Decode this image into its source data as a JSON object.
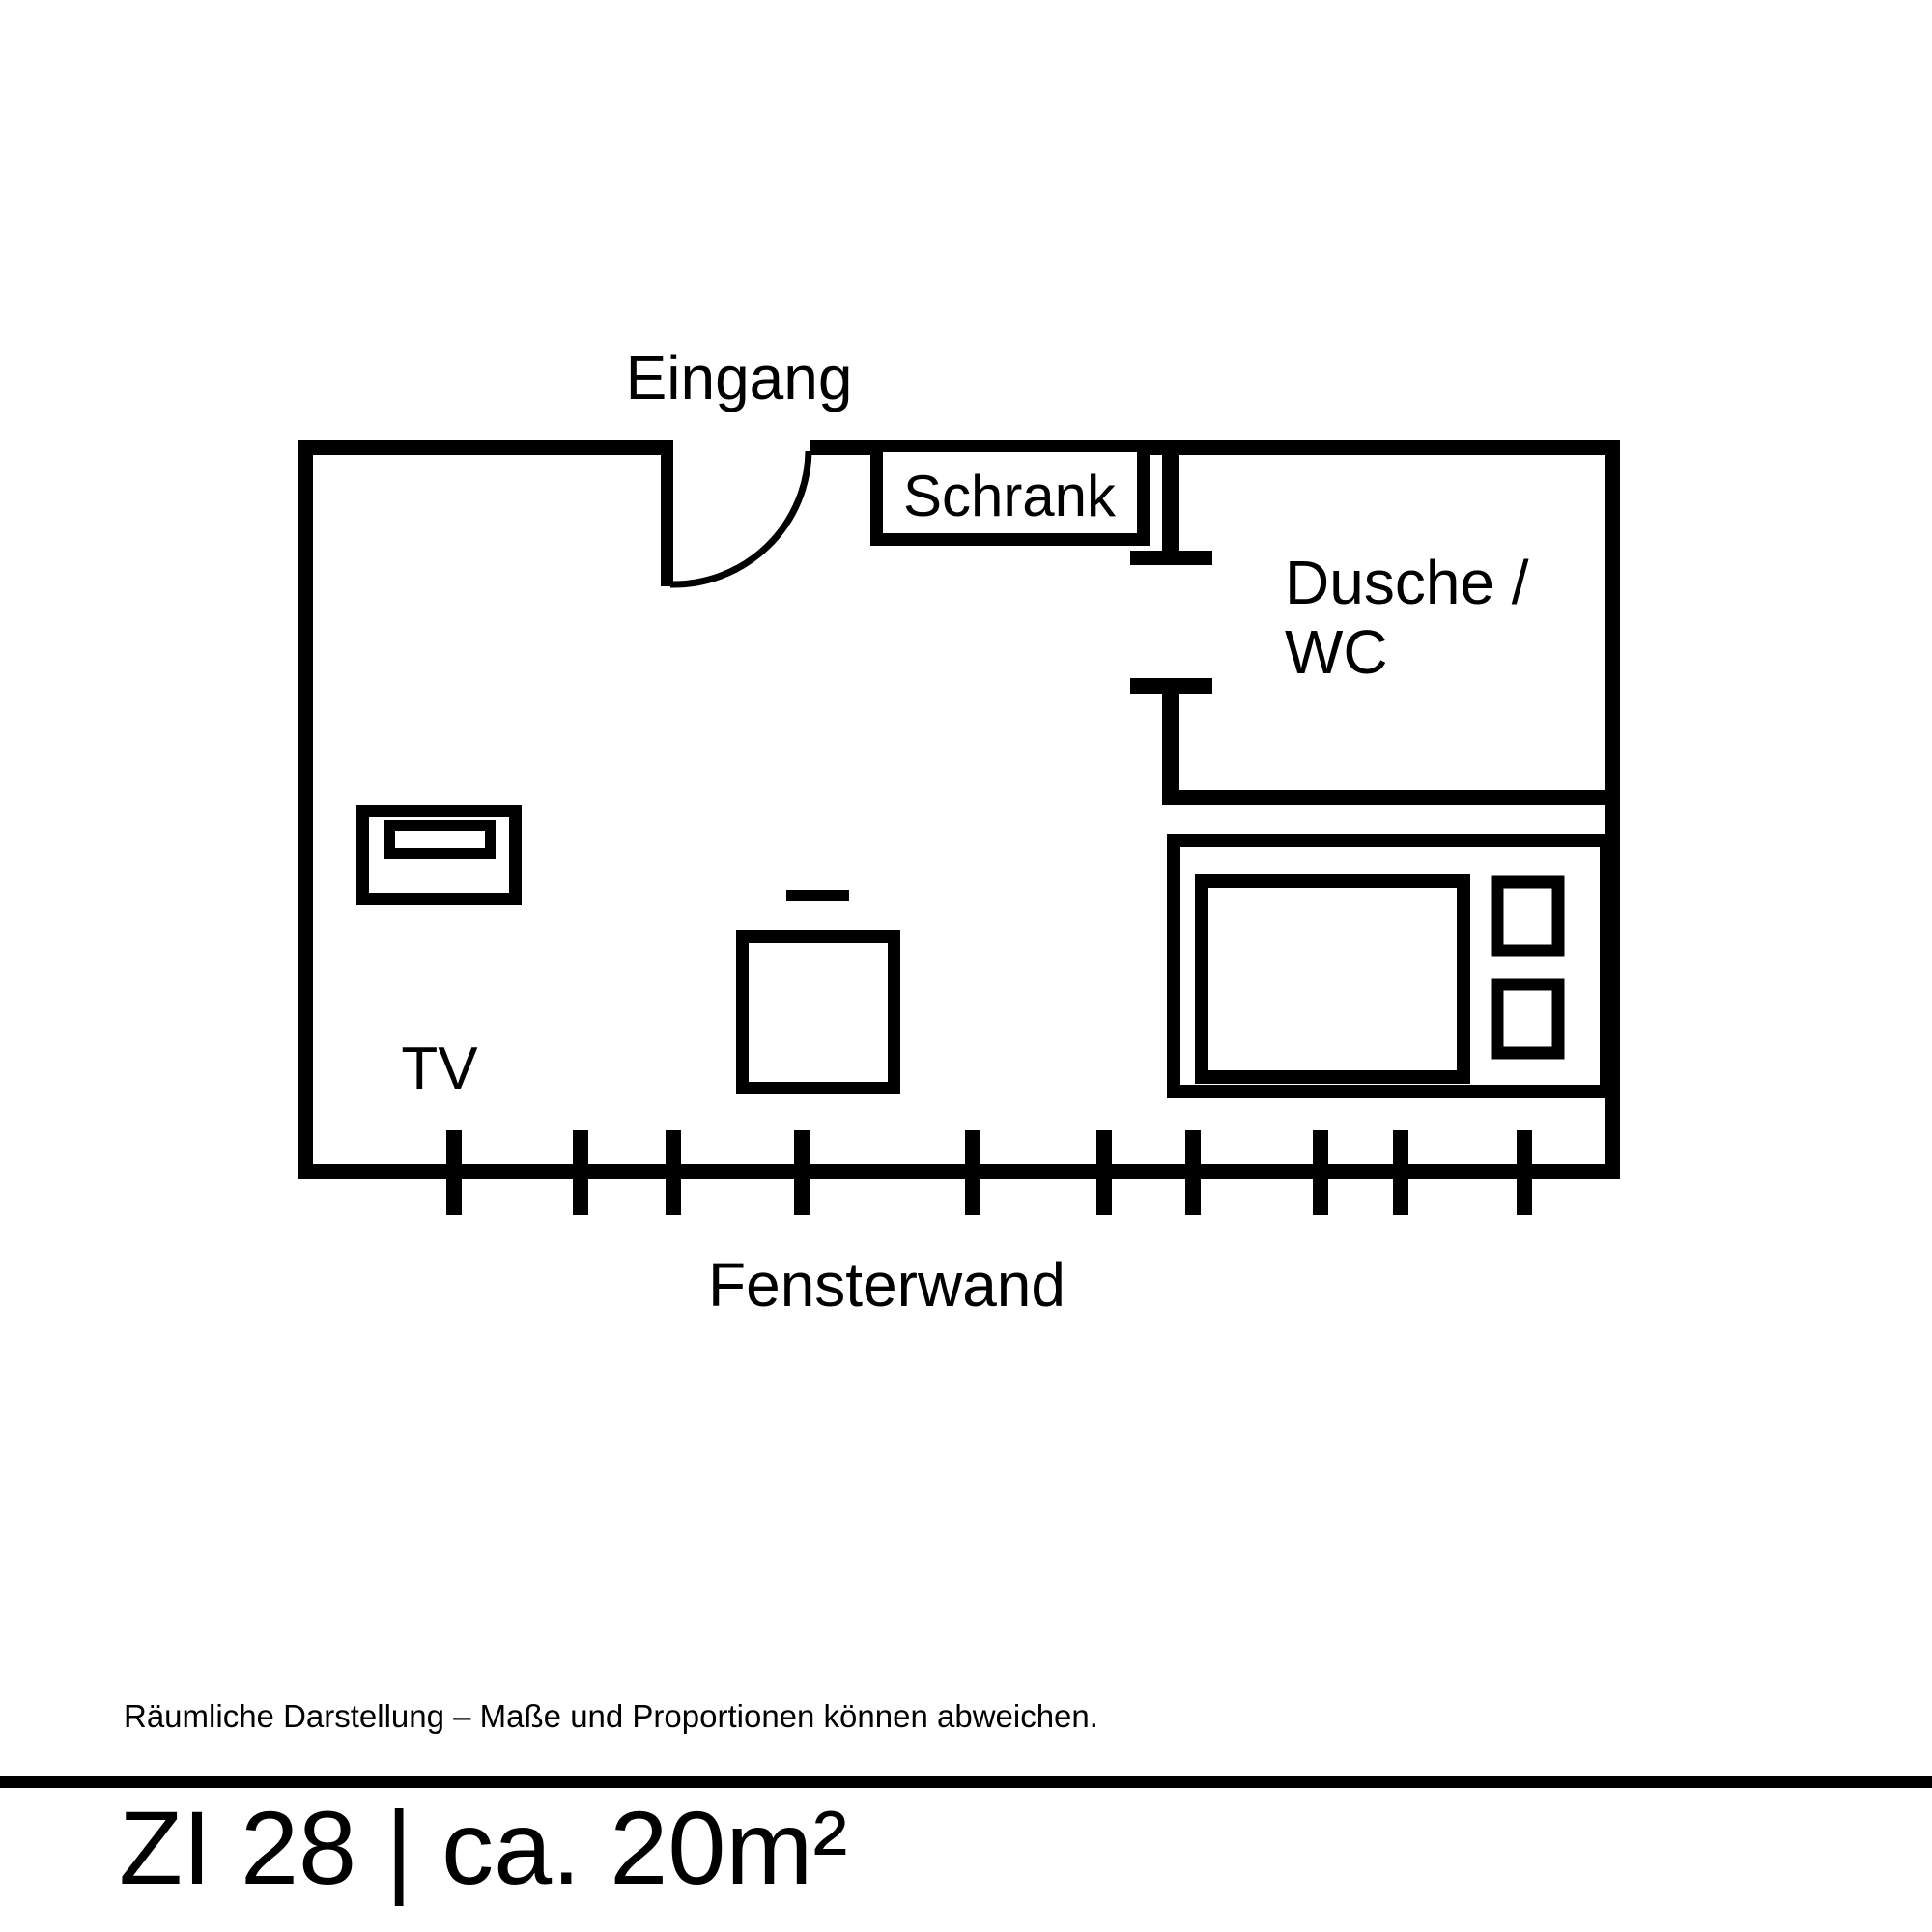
{
  "page": {
    "background_color": "#ffffff",
    "ink_color": "#000000"
  },
  "floor_plan": {
    "entrance_label": "Eingang",
    "wardrobe_label": "Schrank",
    "bathroom_label_line1": "Dusche /",
    "bathroom_label_line2": "WC",
    "tv_label": "TV",
    "window_wall_label": "Fensterwand",
    "window_wall": {
      "tick_count": 10,
      "tick_positions": [
        470,
        601,
        697,
        830,
        1007,
        1143,
        1235,
        1367,
        1450,
        1578
      ]
    }
  },
  "footer": {
    "disclaimer": "Räumliche Darstellung – Maße und Proportionen können abweichen.",
    "room_title": "ZI 28 | ca. 20m²"
  }
}
